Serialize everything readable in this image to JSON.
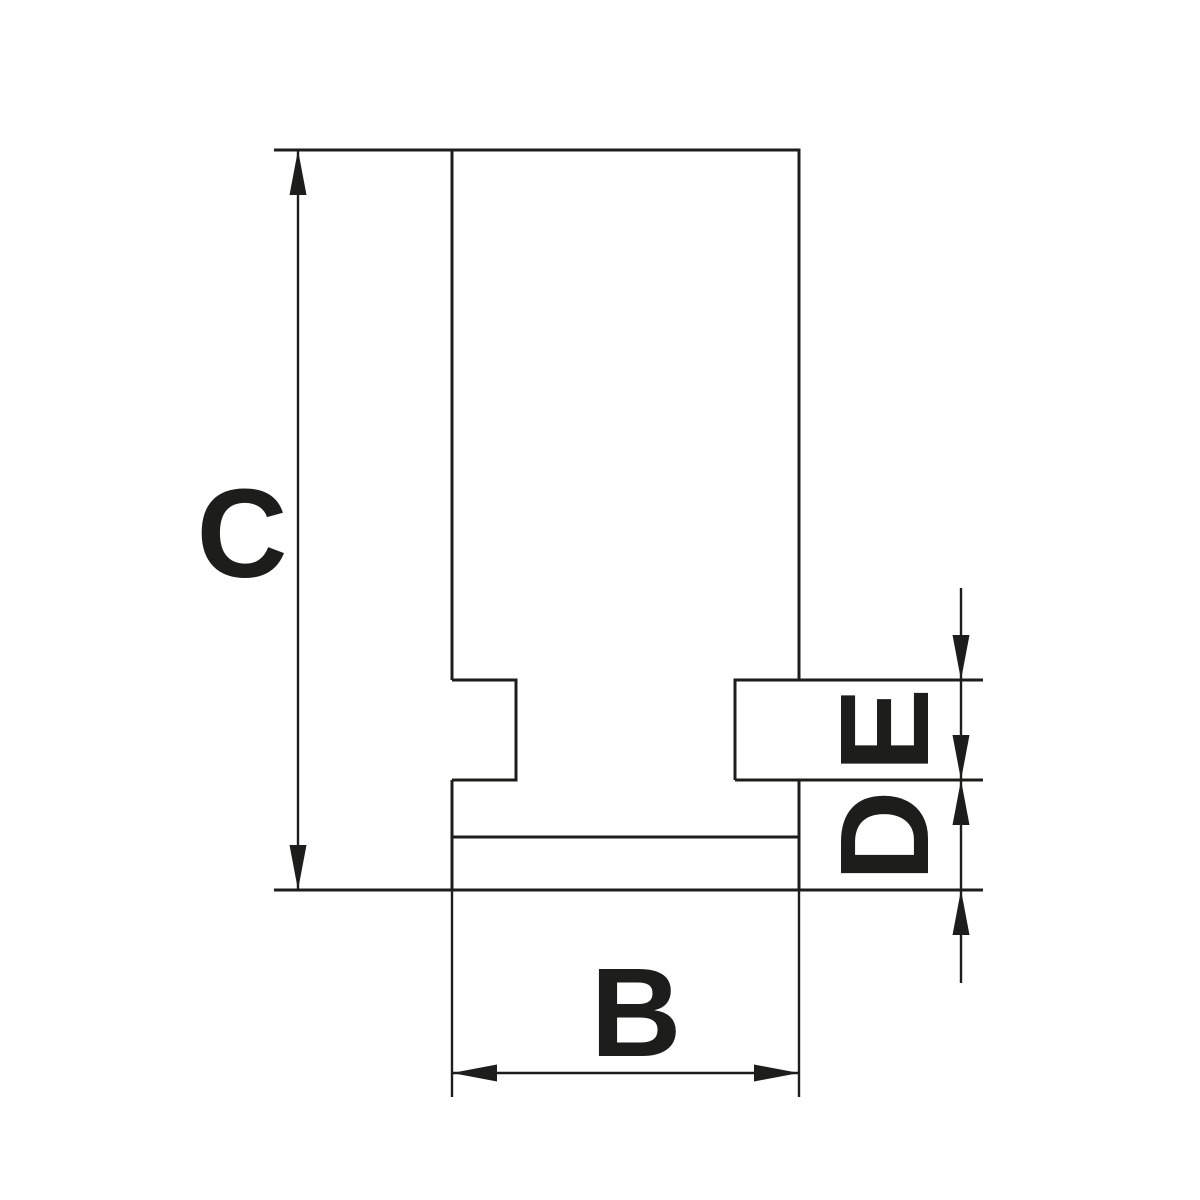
{
  "drawing": {
    "kind": "technical-dimension-drawing",
    "line_color": "#1d1d1b",
    "background_color": "#ffffff",
    "labels": {
      "c": "C",
      "b": "B",
      "e": "E",
      "d": "D"
    }
  }
}
